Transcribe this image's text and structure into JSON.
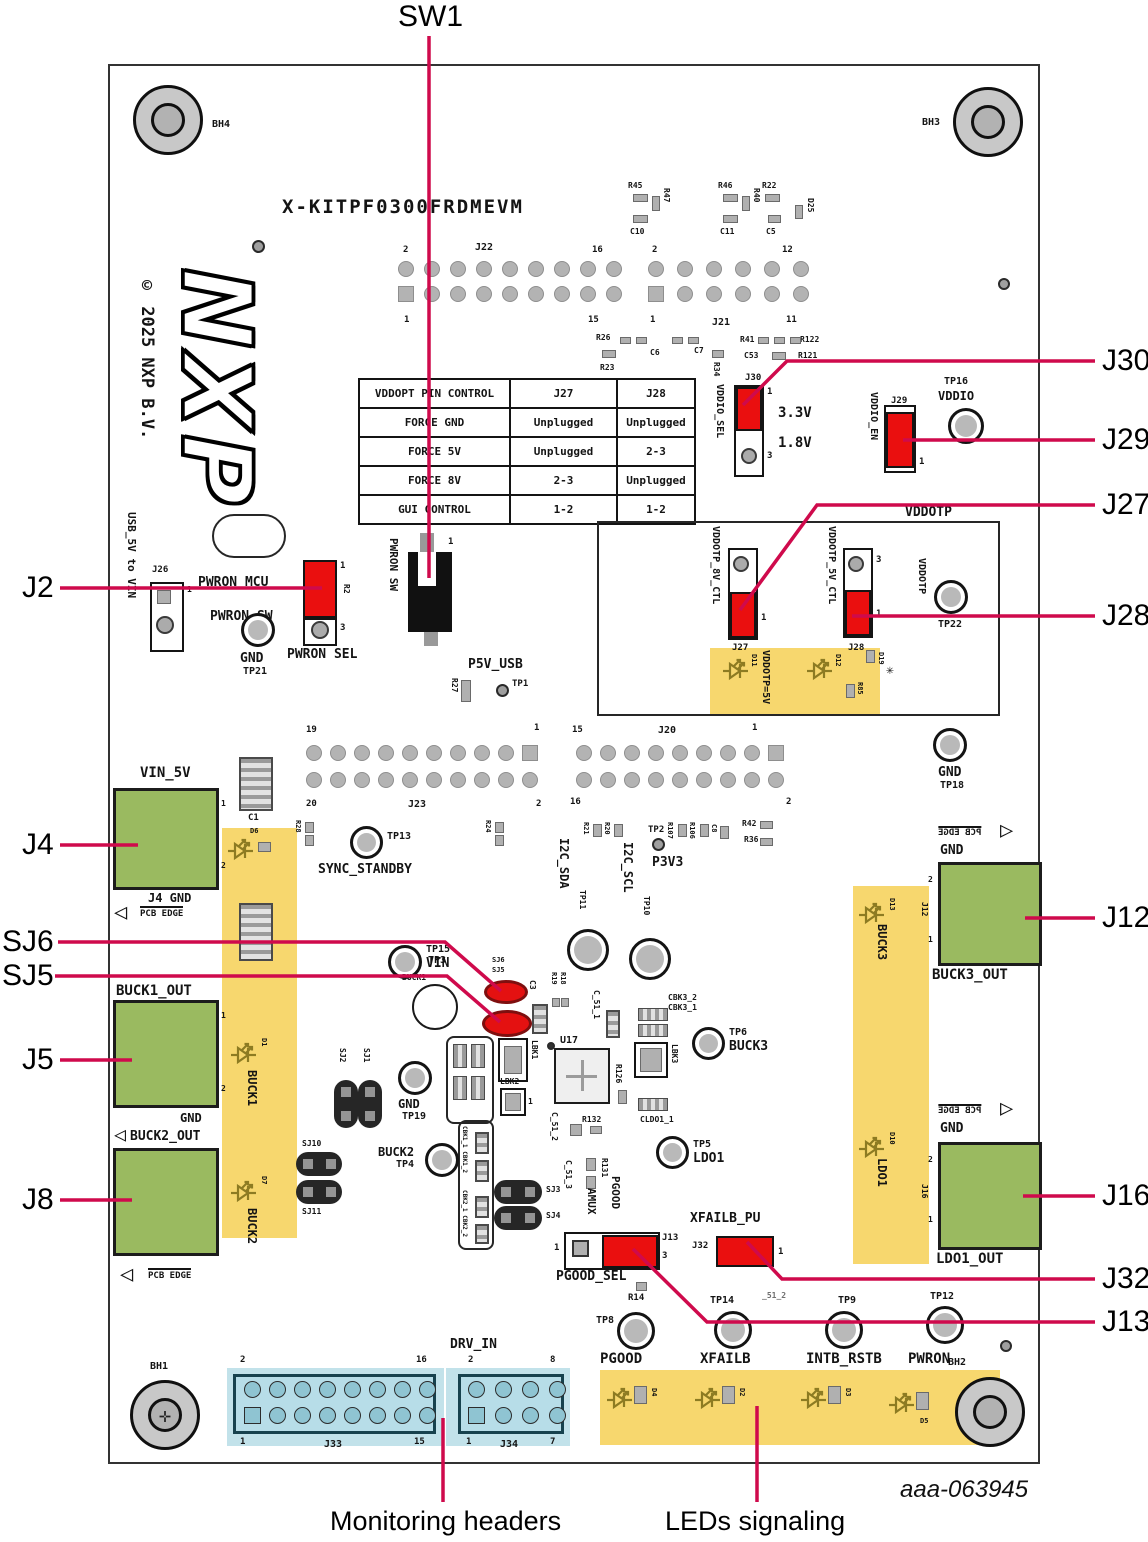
{
  "accent": "#cf0a4c",
  "callouts": {
    "sw1": "SW1",
    "j30": "J30",
    "j29": "J29",
    "j27": "J27",
    "j28": "J28",
    "j2": "J2",
    "sj6": "SJ6",
    "sj5": "SJ5",
    "j4": "J4",
    "j5": "J5",
    "j8": "J8",
    "j12": "J12",
    "j16": "J16",
    "j32": "J32",
    "j13": "J13",
    "monitoring": "Monitoring headers",
    "leds": "LEDs signaling"
  },
  "board": {
    "title": "X-KITPF0300FRDMEVM",
    "copyright": "© 2025 NXP B.V.",
    "logo": "NXP",
    "figure_id": "aaa-063945",
    "bh1": "BH1",
    "bh2": "BH2",
    "bh3": "BH3",
    "bh4": "BH4"
  },
  "table": {
    "c1": "VDDOPT PIN CONTROL",
    "c2": "J27",
    "c3": "J28",
    "rows": [
      [
        "FORCE GND",
        "Unplugged",
        "Unplugged"
      ],
      [
        "FORCE 5V",
        "Unplugged",
        "2-3"
      ],
      [
        "FORCE 8V",
        "2-3",
        "Unplugged"
      ],
      [
        "GUI CONTROL",
        "1-2",
        "1-2"
      ]
    ]
  },
  "labels": {
    "vin5v": "VIN_5V",
    "j4gnd": "J4 GND",
    "pcbedge": "PCB EDGE",
    "buck1out": "BUCK1_OUT",
    "buck2out": "BUCK2_OUT",
    "buck3out": "BUCK3_OUT",
    "ldo1out": "LDO1_OUT",
    "gnd": "GND",
    "sync": "SYNC_STANDBY",
    "usbvin": "USB_5V to VIN",
    "pwronmcu": "PWRON_MCU",
    "pwronswl": "PWRON_SW",
    "pwronsel": "PWRON SEL",
    "pwronsw": "PWRON SW",
    "p5vusb": "P5V_USB",
    "drvin": "DRV_IN",
    "vddiosel": "VDDIO_SEL",
    "vddioen": "VDDIO_EN",
    "v33": "3.3V",
    "v18": "1.8V",
    "vddio": "VDDIO",
    "vddotp": "VDDOTP",
    "v8ctl": "VDDOTP_8V_CTL",
    "v5ctl": "VDDOTP_5V_CTL",
    "votp5": "VDDOTP=5V",
    "i2csda": "I2C_SDA",
    "i2cscl": "I2C_SCL",
    "p3v3": "P3V3",
    "vin": "VIN",
    "buck1": "BUCK1",
    "buck2": "BUCK2",
    "buck3": "BUCK3",
    "ldo1": "LDO1",
    "amux": "AMUX",
    "pgoodv": "PGOOD",
    "pgoodsel": "PGOOD_SEL",
    "xfailbpu": "XFAILB_PU",
    "pgood": "PGOOD",
    "xfailb": "XFAILB",
    "intbrstb": "INTB_RSTB",
    "pwron": "PWRON",
    "s512": "_51_2"
  },
  "pins": {
    "n1": "1",
    "n2": "2",
    "n3": "3",
    "n7": "7",
    "n8": "8",
    "n11": "11",
    "n12": "12",
    "n15": "15",
    "n16": "16",
    "n19": "19",
    "n20": "20"
  },
  "tps": {
    "tp1": "TP1",
    "tp2": "TP2",
    "tp3": "TP3",
    "tp4": "TP4",
    "tp5": "TP5",
    "tp6": "TP6",
    "tp8": "TP8",
    "tp9": "TP9",
    "tp10": "TP10",
    "tp11": "TP11",
    "tp12": "TP12",
    "tp13": "TP13",
    "tp14": "TP14",
    "tp15": "TP15",
    "tp16": "TP16",
    "tp18": "TP18",
    "tp19": "TP19",
    "tp21": "TP21",
    "tp22": "TP22"
  },
  "refs": {
    "j12": "J12",
    "j13": "J13",
    "j16": "J16",
    "j20": "J20",
    "j21": "J21",
    "j22": "J22",
    "j23": "J23",
    "j26": "J26",
    "j27": "J27",
    "j28": "J28",
    "j29": "J29",
    "j30": "J30",
    "j32": "J32",
    "j33": "J33",
    "j34": "J34",
    "r45": "R45",
    "r47": "R47",
    "c10": "C10",
    "r46": "R46",
    "r40": "R40",
    "c11": "C11",
    "r22": "R22",
    "c5": "C5",
    "d25": "D25",
    "r26": "R26",
    "c6": "C6",
    "r23": "R23",
    "c7": "C7",
    "r34": "R34",
    "r41": "R41",
    "c53": "C53",
    "r122": "R122",
    "r121": "R121",
    "r27": "R27",
    "r28": "R28",
    "r24": "R24",
    "r21": "R21",
    "r20": "R20",
    "r107": "R107",
    "r106": "R106",
    "c8": "C8",
    "r42": "R42",
    "r36": "R36",
    "r2": "R2",
    "r14": "R14",
    "u17": "U17",
    "c3": "C3",
    "r19": "R19",
    "r18": "R18",
    "lbk1": "LBK1",
    "lbk2": "LBK2",
    "lbk3": "LBK3",
    "c511": "C_51_1",
    "c512": "C_51_2",
    "c513": "C_51_3",
    "cbk32": "CBK3_2",
    "cbk31": "CBK3_1",
    "cldo11": "CLDO1_1",
    "r126": "R126",
    "r132": "R132",
    "r131": "R131",
    "cbk1": "CBK1_1 CBK1_2",
    "cbk2": "CBK2_1 CBK2_2",
    "sj1": "SJ1",
    "sj2": "SJ2",
    "sj3": "SJ3",
    "sj4": "SJ4",
    "sj5": "SJ5",
    "sj6": "SJ6",
    "sj10": "SJ10",
    "sj11": "SJ11",
    "c1": "C1",
    "d6": "D6",
    "d1": "D1",
    "d7": "D7",
    "d11": "D11",
    "d12": "D12",
    "r85": "R85",
    "d19": "D19",
    "d13": "D13",
    "d10": "D10",
    "d4": "D4",
    "d2": "D2",
    "d3": "D3",
    "d5": "D5"
  }
}
